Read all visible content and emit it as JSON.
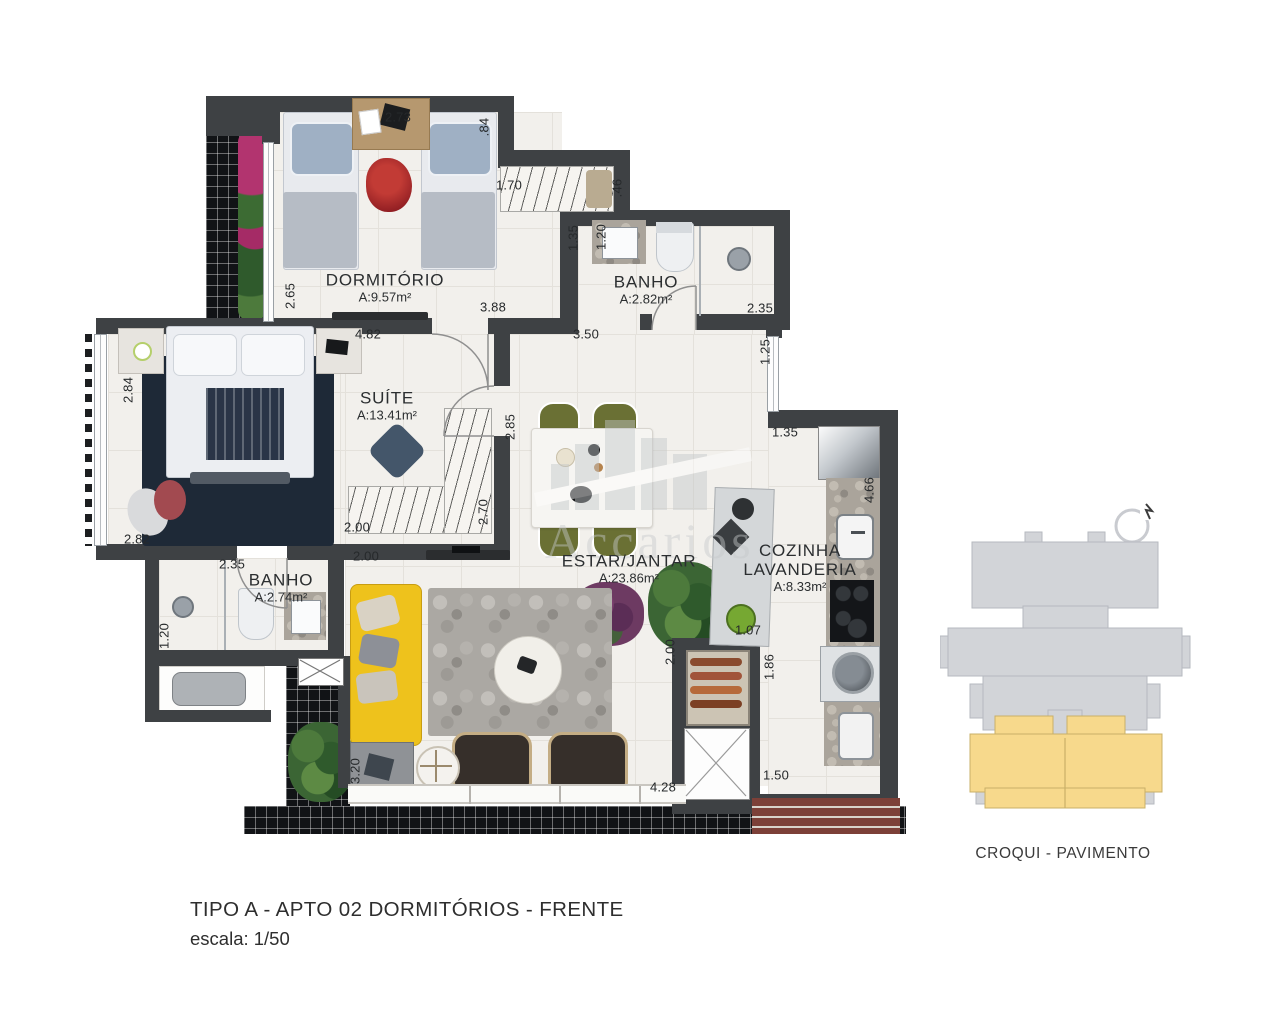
{
  "palette": {
    "wall": "#3e4144",
    "floor": "#f2f0ec",
    "tile_black": "#111316",
    "croqui_gray": "#d2d4d8",
    "croqui_yellow": "#f7d98c",
    "sofa_yellow": "#eec21c",
    "chair_olive": "#6a7034"
  },
  "title": {
    "line1": "TIPO A - APTO 02  DORMITÓRIOS - FRENTE",
    "line2": "escala: 1/50"
  },
  "croqui": {
    "label": "CROQUI - PAVIMENTO"
  },
  "watermark": {
    "text": "Accarios"
  },
  "plan": {
    "rooms": [
      {
        "id": "dormitorio",
        "lines": [
          "DORMITÓRIO"
        ],
        "area": "A:9.57m²",
        "x": 385,
        "y": 288
      },
      {
        "id": "banho-suite",
        "lines": [
          "BANHO"
        ],
        "area": "A:2.82m²",
        "x": 646,
        "y": 290
      },
      {
        "id": "suite",
        "lines": [
          "SUÍTE"
        ],
        "area": "A:13.41m²",
        "x": 387,
        "y": 406
      },
      {
        "id": "banho-social",
        "lines": [
          "BANHO"
        ],
        "area": "A:2.74m²",
        "x": 281,
        "y": 588
      },
      {
        "id": "estar-jantar",
        "lines": [
          "ESTAR/JANTAR"
        ],
        "area": "A:23.86m²",
        "x": 629,
        "y": 569
      },
      {
        "id": "cozinha-lavanderia",
        "lines": [
          "COZINHA",
          "LAVANDERIA"
        ],
        "area": "A:8.33m²",
        "x": 800,
        "y": 568
      }
    ],
    "dimensions": [
      {
        "t": "2.73",
        "x": 398,
        "y": 117
      },
      {
        "t": ".84",
        "x": 484,
        "y": 127,
        "v": 1
      },
      {
        "t": "1.70",
        "x": 509,
        "y": 185
      },
      {
        "t": ".46",
        "x": 617,
        "y": 188,
        "v": 1
      },
      {
        "t": "1.35",
        "x": 573,
        "y": 238,
        "v": 1
      },
      {
        "t": "1.20",
        "x": 601,
        "y": 237,
        "v": 1
      },
      {
        "t": "2.65",
        "x": 290,
        "y": 296,
        "v": 1
      },
      {
        "t": "3.88",
        "x": 493,
        "y": 307
      },
      {
        "t": "2.35",
        "x": 760,
        "y": 308
      },
      {
        "t": "4.82",
        "x": 368,
        "y": 334
      },
      {
        "t": "3.50",
        "x": 586,
        "y": 334
      },
      {
        "t": "1.25",
        "x": 765,
        "y": 352,
        "v": 1
      },
      {
        "t": "2.84",
        "x": 128,
        "y": 390,
        "v": 1
      },
      {
        "t": "2.85",
        "x": 510,
        "y": 427,
        "v": 1
      },
      {
        "t": "1.35",
        "x": 785,
        "y": 432
      },
      {
        "t": "4.66",
        "x": 869,
        "y": 490,
        "v": 1
      },
      {
        "t": "2.70",
        "x": 483,
        "y": 512,
        "v": 1
      },
      {
        "t": "2.00",
        "x": 357,
        "y": 527
      },
      {
        "t": "2.82",
        "x": 137,
        "y": 539
      },
      {
        "t": "2.00",
        "x": 366,
        "y": 556
      },
      {
        "t": "2.35",
        "x": 232,
        "y": 564
      },
      {
        "t": "1.07",
        "x": 748,
        "y": 630
      },
      {
        "t": "1.20",
        "x": 164,
        "y": 636,
        "v": 1
      },
      {
        "t": "2.00",
        "x": 670,
        "y": 652,
        "v": 1
      },
      {
        "t": "1.86",
        "x": 769,
        "y": 667,
        "v": 1
      },
      {
        "t": "3.20",
        "x": 355,
        "y": 771,
        "v": 1
      },
      {
        "t": "1.50",
        "x": 776,
        "y": 775
      },
      {
        "t": "4.28",
        "x": 663,
        "y": 787
      }
    ]
  }
}
